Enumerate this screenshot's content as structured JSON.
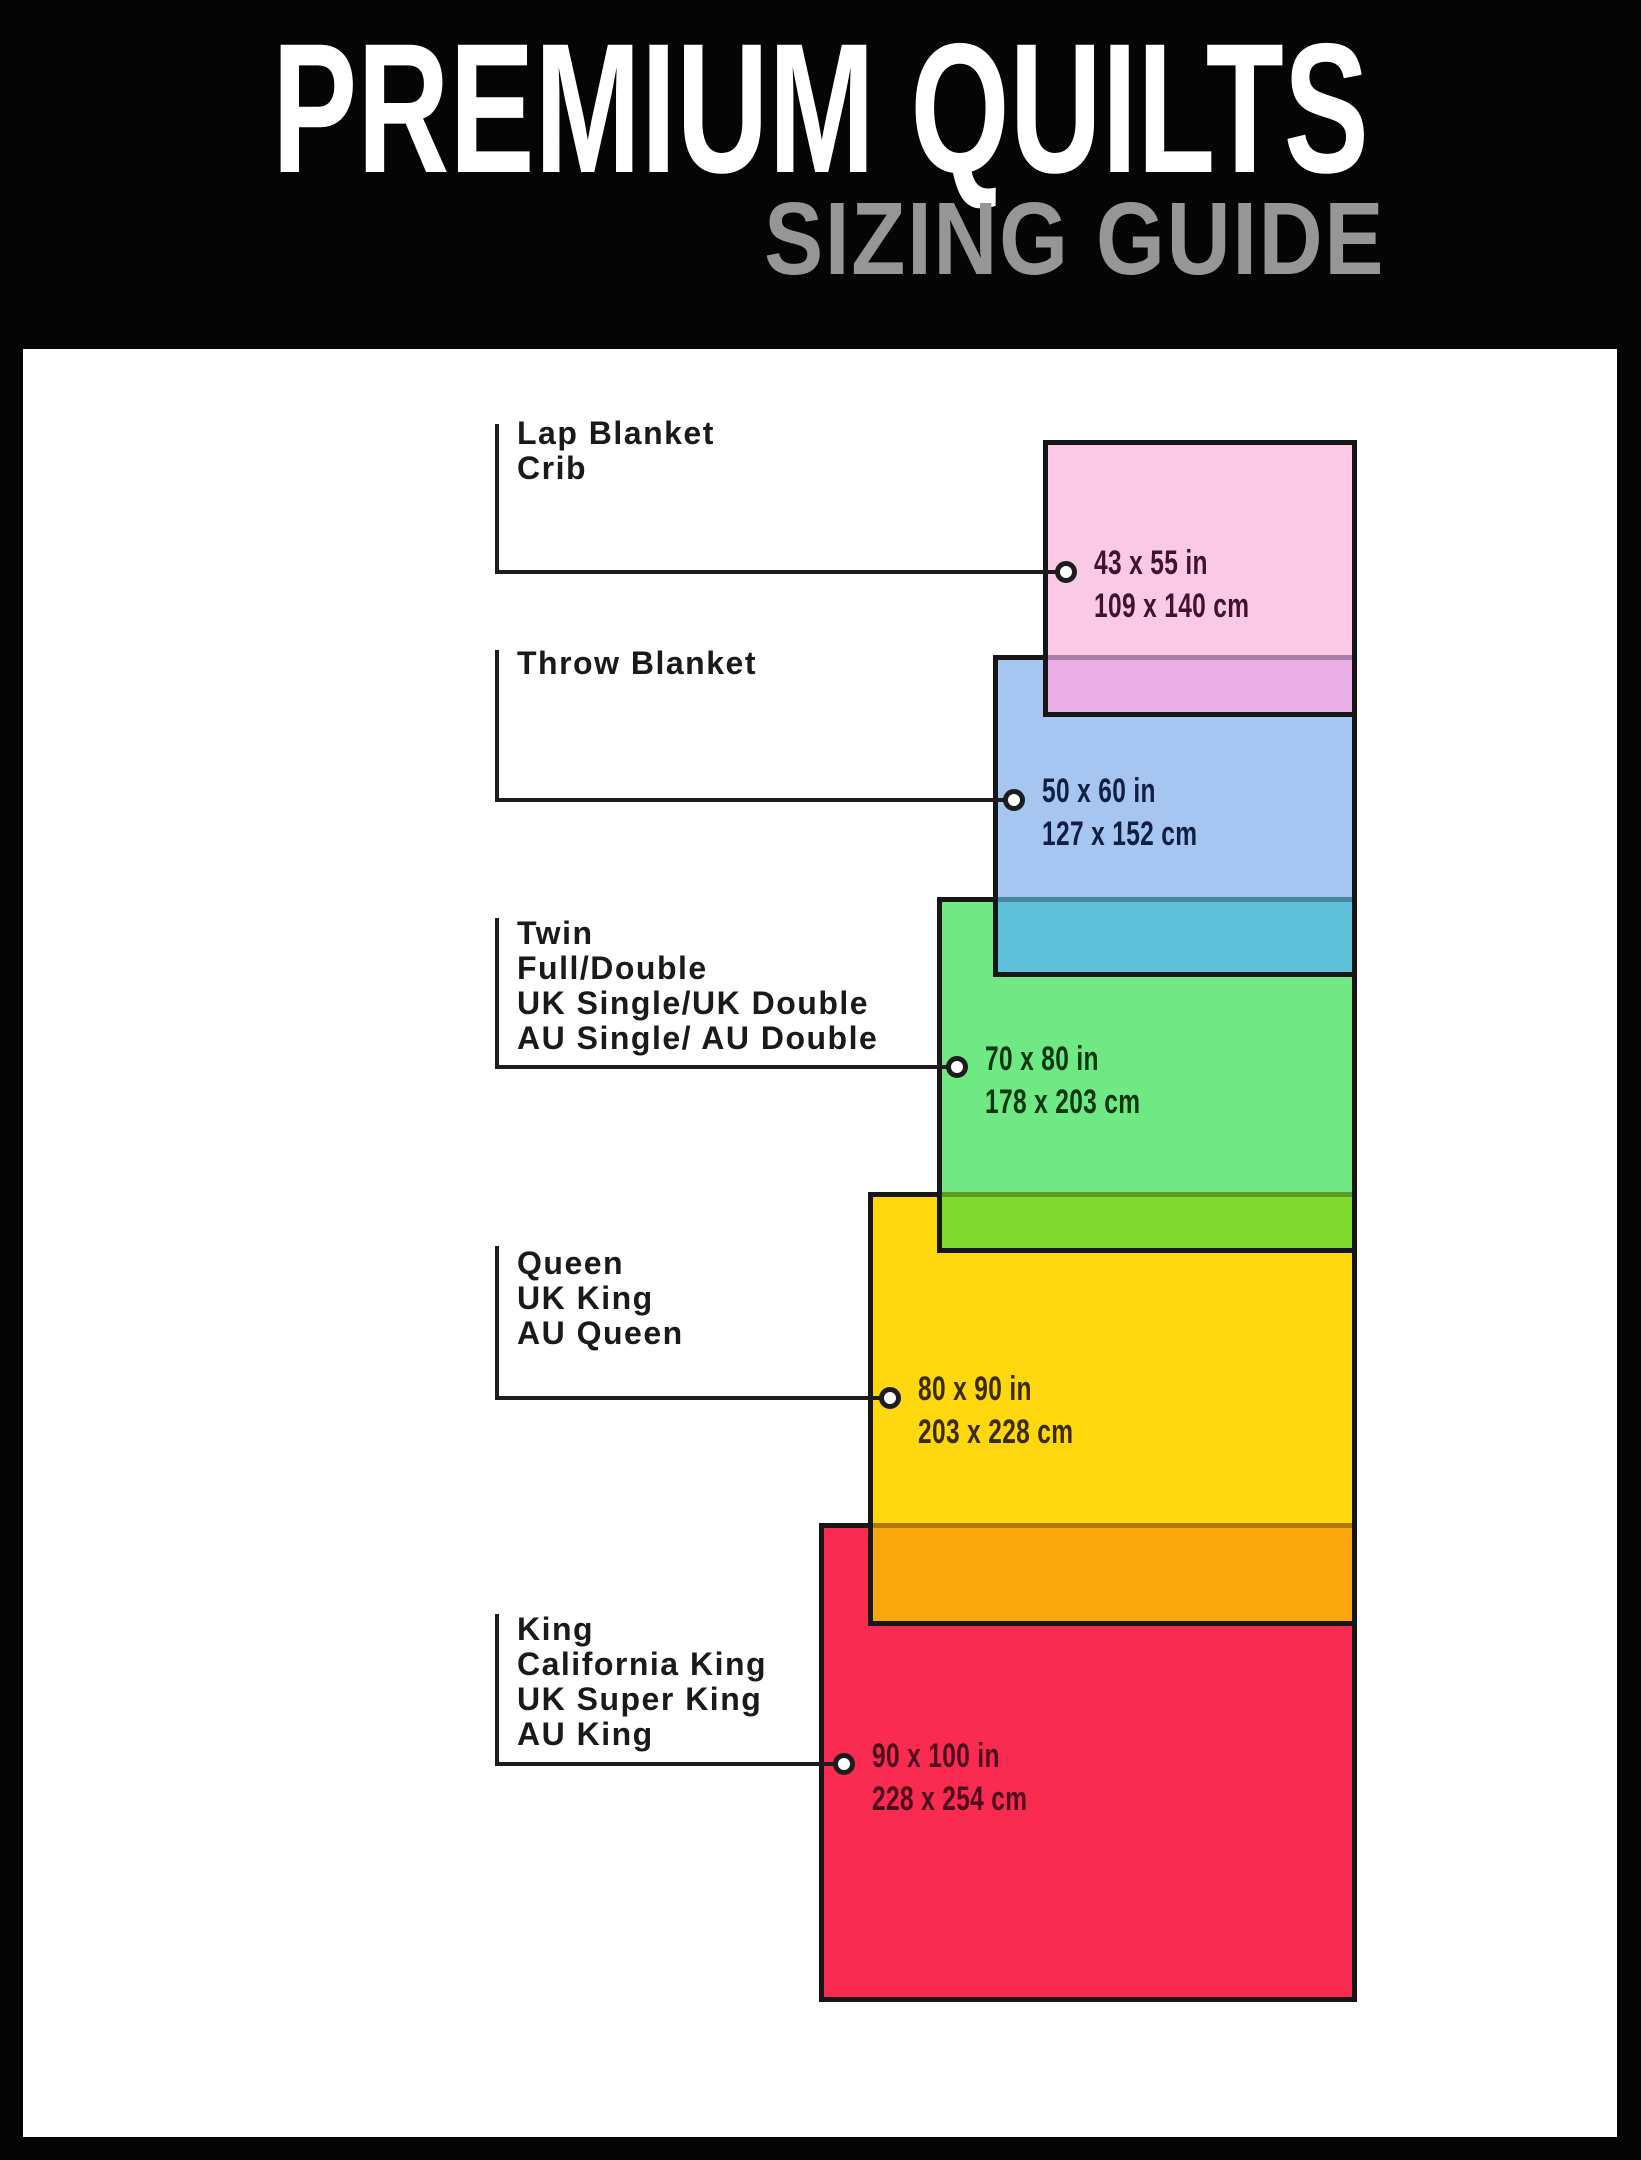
{
  "header": {
    "title": "PREMIUM QUILTS",
    "subtitle": "SIZING GUIDE",
    "title_color": "#ffffff",
    "subtitle_color": "#969696"
  },
  "sizes": [
    {
      "names": [
        "Lap Blanket",
        "Crib"
      ],
      "inches": "43 x 55 in",
      "cm": "109 x 140 cm",
      "fill": "#fac9e6",
      "text_color": "#42142c"
    },
    {
      "names": [
        "Throw Blanket"
      ],
      "inches": "50 x 60 in",
      "cm": "127 x 152 cm",
      "fill": "#a6c6f1",
      "text_color": "#101f42"
    },
    {
      "names": [
        "Twin",
        "Full/Double",
        "UK Single/UK Double",
        "AU Single/ AU Double"
      ],
      "inches": "70 x 80 in",
      "cm": "178 x 203 cm",
      "fill": "#70e883",
      "text_color": "#06370f"
    },
    {
      "names": [
        "Queen",
        "UK King",
        "AU Queen"
      ],
      "inches": "80 x 90 in",
      "cm": "203 x 228 cm",
      "fill": "#ffd70e",
      "text_color": "#3a2b02"
    },
    {
      "names": [
        "King",
        "California King",
        "UK Super King",
        "AU King"
      ],
      "inches": "90 x 100 in",
      "cm": "228 x 254 cm",
      "fill": "#fa2b51",
      "text_color": "#4d0d1c"
    }
  ],
  "overlaps": [
    {
      "pair": "crib-over-throw",
      "color": "#ebafe8"
    },
    {
      "pair": "throw-over-twin",
      "color": "#5fc0d9"
    },
    {
      "pair": "twin-over-queen",
      "color": "#80d92f"
    },
    {
      "pair": "queen-over-king",
      "color": "#faa70e"
    }
  ],
  "frame": {
    "background": "#050505",
    "canvas": "#ffffff",
    "line": "#1d1d1d"
  }
}
